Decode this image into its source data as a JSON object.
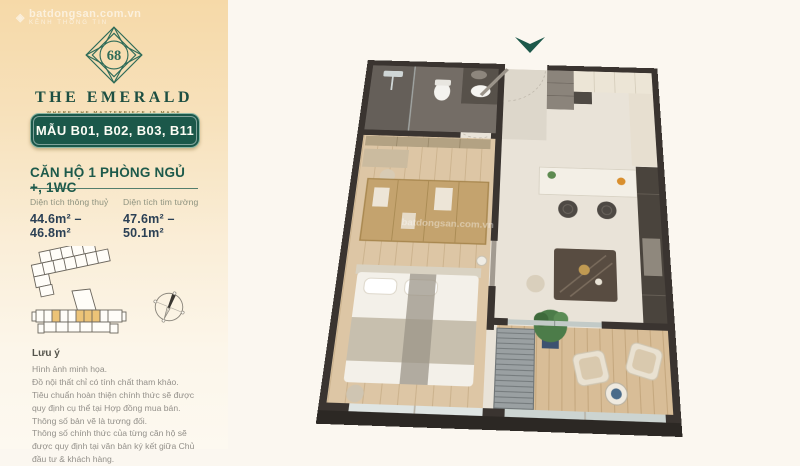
{
  "watermark": {
    "text": "batdongsan.com.vn",
    "sub": "KÊNH THÔNG TIN"
  },
  "sidebar": {
    "logo": {
      "number": "68",
      "title": "THE EMERALD",
      "tagline": "WHERE THE MASTERPIECE IS MADE"
    },
    "badge_label": "MẪU B01, B02, B03, B11",
    "unit_type": "CĂN HỘ 1 PHÒNG NGỦ +, 1WC",
    "areas": [
      {
        "label": "Diện tích thông thuỷ",
        "value": "44.6m² – 46.8m²"
      },
      {
        "label": "Diện tích tim tường",
        "value": "47.6m² – 50.1m²"
      }
    ],
    "notes_title": "Lưu ý",
    "notes": [
      "Hình ảnh minh họa.",
      "Đồ nội thất chỉ có tính chất tham khảo.",
      "Tiêu chuẩn hoàn thiện chính thức sẽ được quy định cụ thể tại Hợp đồng mua bán.",
      "Thông số bản vẽ là tương đối.",
      "Thông số chính thức của từng căn hộ sẽ được quy định tại văn bản ký kết giữa Chủ đầu tư & khách hàng."
    ]
  },
  "colors": {
    "brand_green": "#1b584a",
    "panel_gold": "#f6d9a8",
    "value_navy": "#2b4055",
    "unit_highlight": "#ecc377",
    "wall_dark": "#3a3430"
  }
}
